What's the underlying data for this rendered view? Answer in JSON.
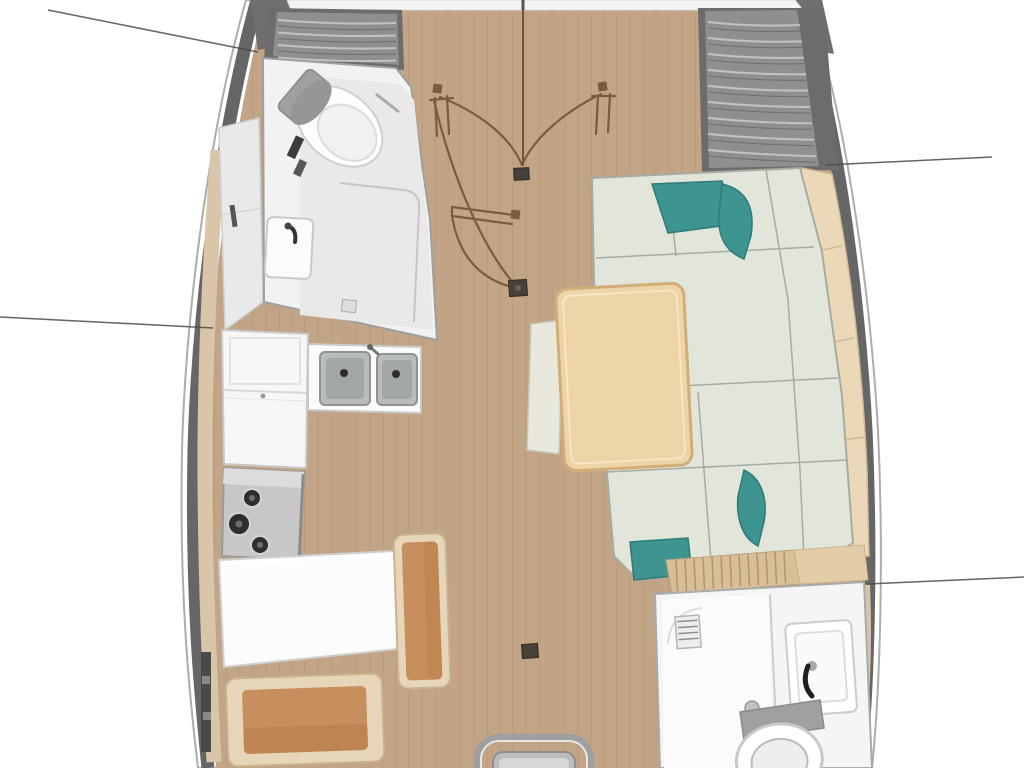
{
  "meta": {
    "title": "Sailboat interior floor plan — top view",
    "image_type": "yacht layout illustration",
    "visible_text": []
  },
  "colors": {
    "bg": "#FFFFFF",
    "hull_line": "#ADADAD",
    "hull_band": "#666666",
    "hull_wedge": "#6F6F6F",
    "wood": "#C2A486",
    "plank": "#A98A6E",
    "shelf": "#D9C6AA",
    "locker": "#E9E9E9",
    "locker_line": "#CFCFCF",
    "foredeck": "#F4F4F4",
    "cushion_gray": "#8F8F8F",
    "cushion_gray_dark": "#6C6C6C",
    "pleat_light": "#C2C2C2",
    "pleat_dark": "#5E5E5E",
    "head_room": "#F2F2F2",
    "head_panel": "#E9E9E9",
    "white_fixture": "#FBFBFB",
    "fixture_line": "#C9C9C9",
    "toilet_tank": "#A0A0A0",
    "toilet_lid": "#969696",
    "dark_detail": "#3C3C3C",
    "steel": "#C7C7C7",
    "steel_light": "#DCDCDC",
    "steel_dark": "#9B9B9B",
    "sink_steel": "#B9BCBC",
    "sink_steel_deep": "#A3A6A6",
    "burner": "#2E2E2E",
    "sofa": "#E2E5DA",
    "sofa_seam": "#A6ACA1",
    "teal": "#3E948F",
    "teal_dark": "#2F7B78",
    "backrest": "#EAD8B8",
    "backrest_seam": "#CDB996",
    "table": "#EED5A7",
    "table_edge": "#D3AD78",
    "table_hilite": "#F6E6C4",
    "pale_bench": "#E9E8DC",
    "pale_bench_edge": "#C8C8BA",
    "bench_frame": "#E6D5B9",
    "bench_frame_edge": "#C9B28E",
    "bench_cushion": "#C78F5D",
    "bench_cushion_shade": "#B77D49",
    "slat_wood": "#D8BF99",
    "slat_line": "#B2946E",
    "ledge": "#E4CDA6",
    "door": "#7A5C3E",
    "leader": "#4A4A4A",
    "floor_fitting": "#48413A",
    "floor_fitting_edge": "#2E2A24"
  },
  "rooms": [
    {
      "id": "forward-cabin",
      "name": "forward cabin with quilted berth cushions and double doors"
    },
    {
      "id": "forward-head",
      "name": "forward bathroom with toilet and sink"
    },
    {
      "id": "galley",
      "name": "L-shaped galley with double sink and three-burner stove"
    },
    {
      "id": "salon",
      "name": "salon with L-shaped sofa, teal pillows and table"
    },
    {
      "id": "nav-station",
      "name": "chart table with bench seats"
    },
    {
      "id": "aft-head",
      "name": "aft bathroom with sink and toilet"
    },
    {
      "id": "companionway",
      "name": "companionway steps"
    }
  ],
  "callouts": [
    {
      "id": "leader-top-left",
      "x1": 48,
      "y1": 10,
      "x2": 258,
      "y2": 52
    },
    {
      "id": "leader-right-upper",
      "x1": 826,
      "y1": 165,
      "x2": 992,
      "y2": 157
    },
    {
      "id": "leader-left-mid",
      "x1": 0,
      "y1": 317,
      "x2": 213,
      "y2": 328
    },
    {
      "id": "leader-right-lower",
      "x1": 868,
      "y1": 584,
      "x2": 1024,
      "y2": 577
    }
  ]
}
